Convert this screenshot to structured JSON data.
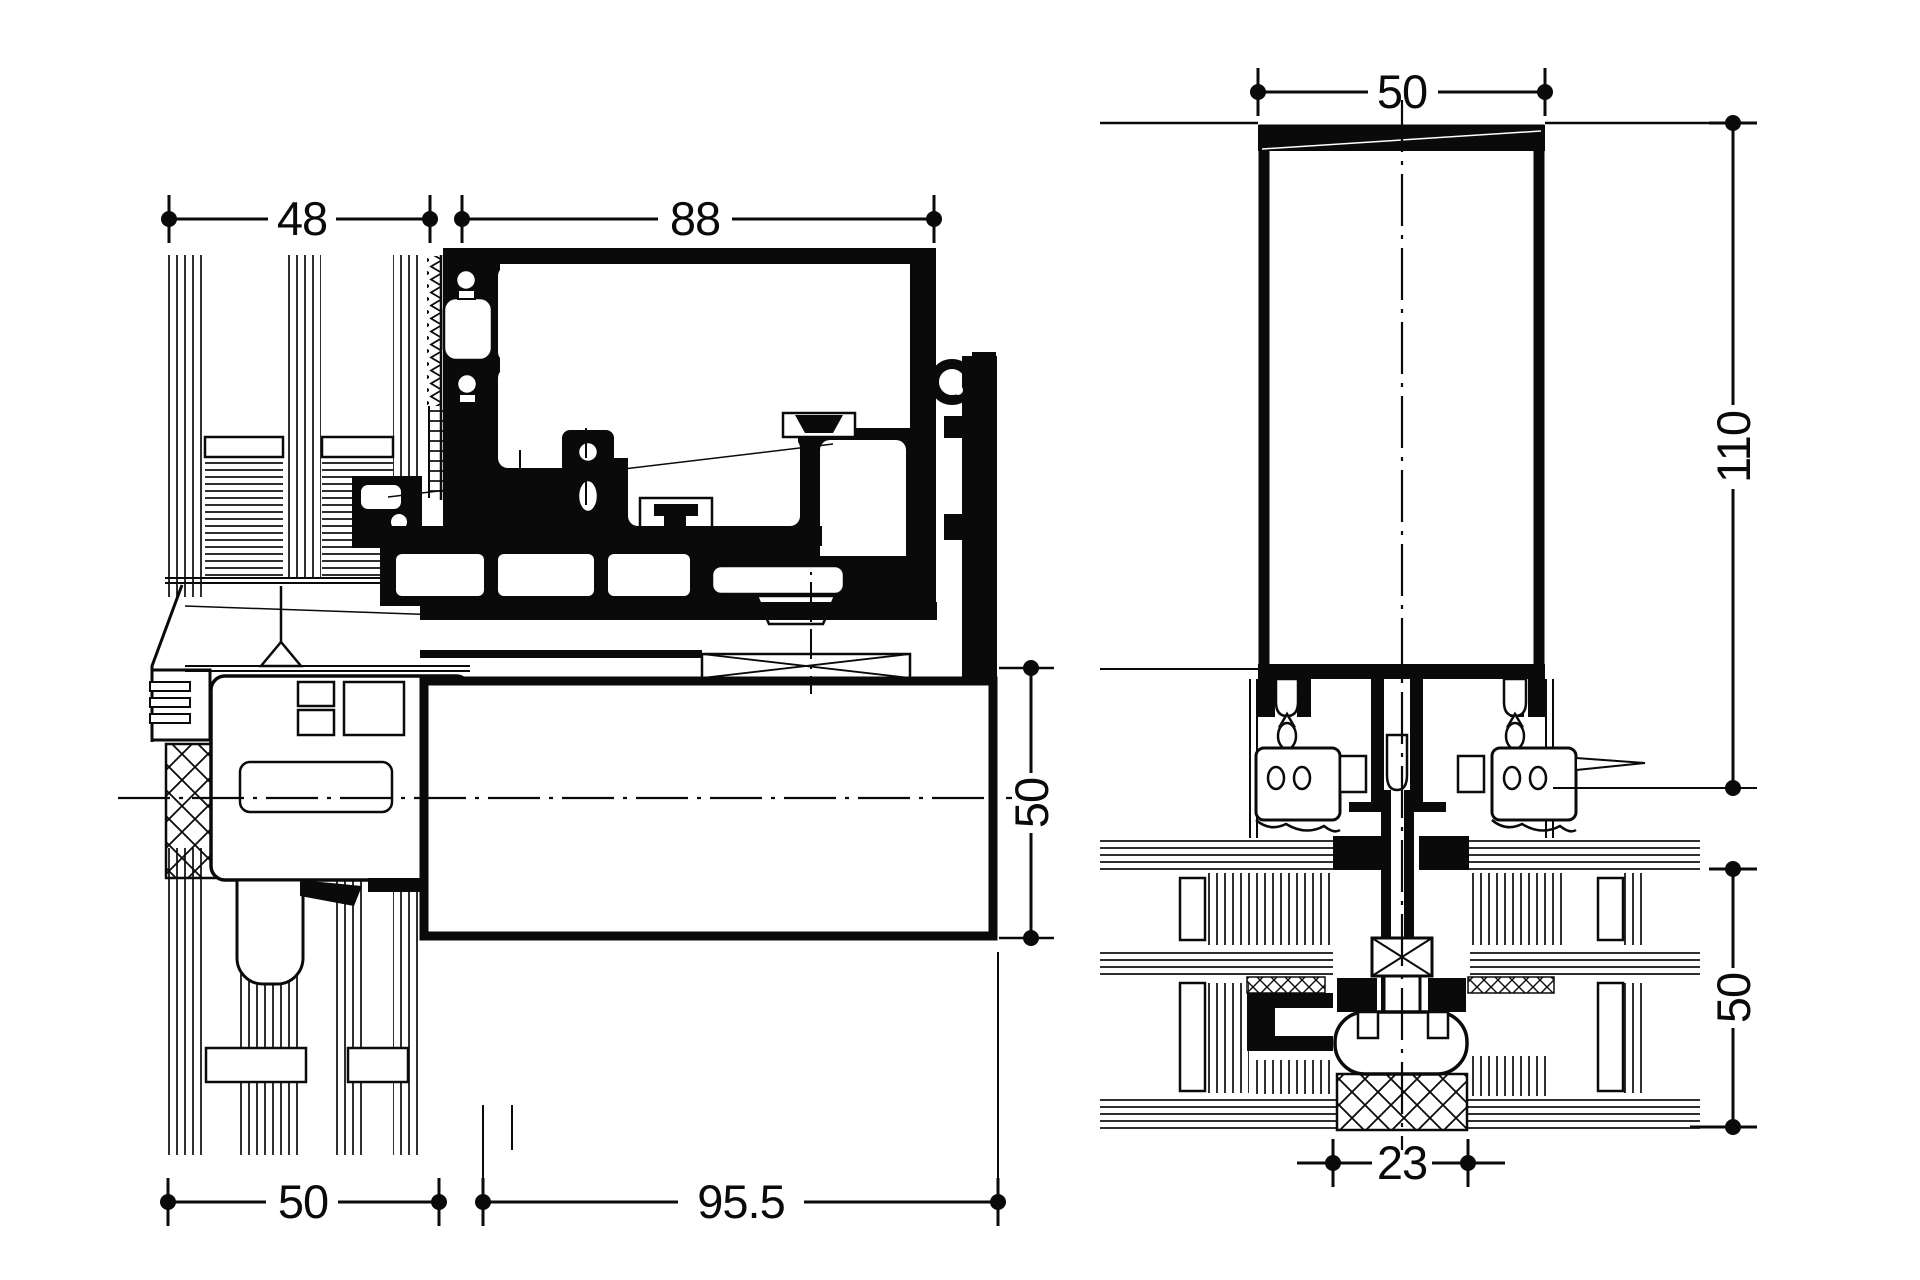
{
  "drawing": {
    "type": "technical-section-drawing",
    "colors": {
      "ink": "#0a0a0a",
      "paper": "#ffffff"
    },
    "left_view": {
      "name": "horizontal section through frame and glazed wall",
      "dims": {
        "top_left": "48",
        "top_right": "88",
        "right": "50",
        "bottom_left": "50",
        "bottom_right": "95.5"
      }
    },
    "right_view": {
      "name": "vertical section through mullion and transom",
      "dims": {
        "top": "50",
        "right_upper": "110",
        "right_lower": "50",
        "bottom": "23"
      }
    }
  }
}
